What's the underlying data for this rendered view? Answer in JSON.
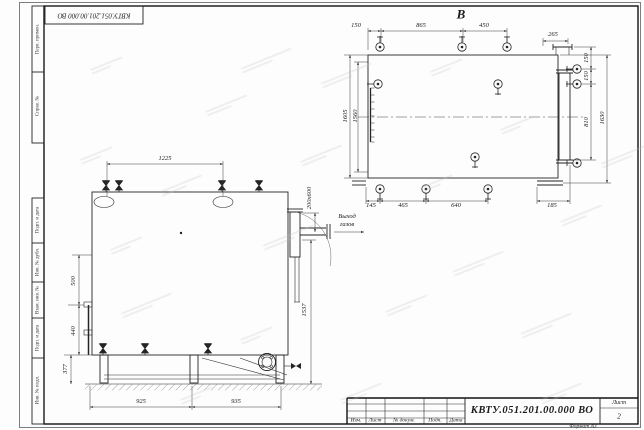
{
  "frame": {
    "stamp_number": "КВТУ.051.201.00.000 ВО",
    "side_labels": {
      "perv": "Перв. примен.",
      "sprav": "Справ. №",
      "podp1": "Подп. и дата",
      "inv_dubl": "Инв. № дубл.",
      "vzam": "Взам. инв. №",
      "podp2": "Подп. и дата",
      "inv_podl": "Инв. № подл."
    },
    "title_block": {
      "doc_number": "КВТУ.051.201.00.000 ВО",
      "col_izm": "Изм.",
      "col_list": "Лист",
      "col_doc": "№ докум.",
      "col_podp": "Подп.",
      "col_data": "Дата",
      "sheet_label": "Лист",
      "sheet_number": "2",
      "format": "Формат А3"
    }
  },
  "front_view": {
    "dim_top_width": "1225",
    "dim_left_upper": "500",
    "dim_left_mid": "440",
    "dim_left_lower": "377",
    "dim_bottom_left": "925",
    "dim_bottom_right": "935",
    "outlet_size": "200х600",
    "dim_right_height": "1537",
    "outlet_label_1": "Выход",
    "outlet_label_2": "газов"
  },
  "top_view": {
    "view_label": "В",
    "dim_150_left": "150",
    "dim_865": "865",
    "dim_450": "450",
    "dim_265": "265",
    "dim_150_right_top": "150",
    "dim_150_right_mid": "150",
    "dim_810": "810",
    "dim_1630": "1630",
    "dim_1605": "1605",
    "dim_1560": "1560",
    "dim_145": "145",
    "dim_465": "465",
    "dim_640": "640",
    "dim_185": "185"
  }
}
